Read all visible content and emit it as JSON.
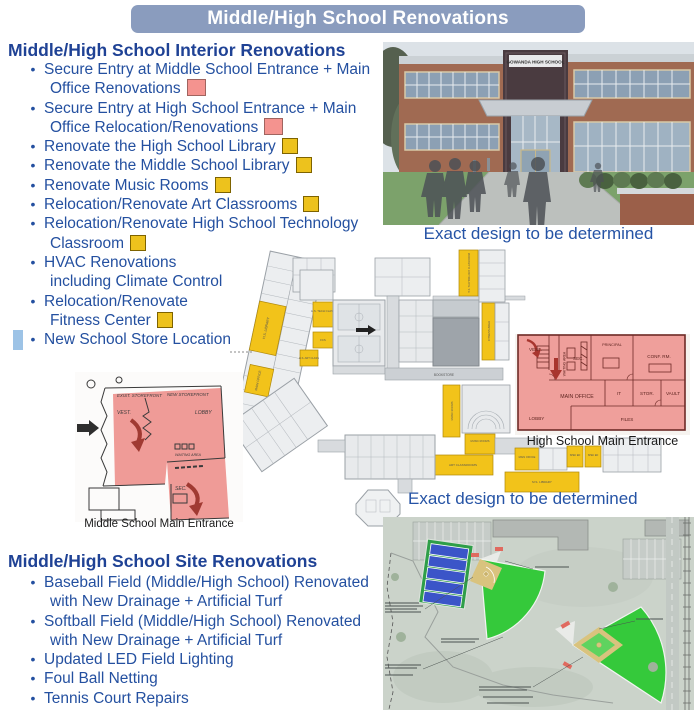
{
  "title": "Middle/High School Renovations",
  "interior": {
    "heading": "Middle/High School Interior Renovations",
    "items": [
      {
        "lines": [
          "Secure Entry at Middle School Entrance + Main",
          "Office Renovations"
        ],
        "swatch": "pink"
      },
      {
        "lines": [
          "Secure Entry at High School Entrance + Main",
          "Office Relocation/Renovations"
        ],
        "swatch": "pink"
      },
      {
        "lines": [
          "Renovate the High School Library"
        ],
        "swatch": "yellow"
      },
      {
        "lines": [
          "Renovate the Middle School Library"
        ],
        "swatch": "yellow"
      },
      {
        "lines": [
          "Renovate Music Rooms"
        ],
        "swatch": "yellow"
      },
      {
        "lines": [
          "Relocation/Renovate Art Classrooms"
        ],
        "swatch": "yellow"
      },
      {
        "lines": [
          "Relocation/Renovate High School Technology",
          "Classroom"
        ],
        "swatch": "yellow"
      },
      {
        "lines": [
          "HVAC Renovations",
          "including Climate Control"
        ],
        "swatch": "none"
      },
      {
        "lines": [
          "Relocation/Renovate",
          "Fitness Center"
        ],
        "swatch": "yellow"
      },
      {
        "lines": [
          "New School Store Location"
        ],
        "swatch": "none",
        "highlight": true
      }
    ]
  },
  "site": {
    "heading": "Middle/High School Site Renovations",
    "items": [
      {
        "lines": [
          "Baseball Field (Middle/High School) Renovated",
          "with New Drainage + Artificial Turf"
        ],
        "swatch": "none"
      },
      {
        "lines": [
          "Softball Field (Middle/High School) Renovated",
          "with New Drainage + Artificial Turf"
        ],
        "swatch": "none"
      },
      {
        "lines": [
          "Updated LED Field Lighting"
        ],
        "swatch": "none"
      },
      {
        "lines": [
          "Foul Ball Netting"
        ],
        "swatch": "none"
      },
      {
        "lines": [
          "Tennis Court Repairs"
        ],
        "swatch": "none"
      }
    ]
  },
  "rendering": {
    "sign": "GOWANDA HIGH SCHOOL",
    "caption": "Exact design to be determined"
  },
  "floorplan": {
    "caption": "Exact design to be determined",
    "labels": {
      "hs_library": "H.S. LIBRARY",
      "main_office_wing": "MAIN OFFICE",
      "hs_tech_class": "H.S. TECH CLASS",
      "fcs": "FCS",
      "hs_art_class": "H.S. ART CLASS",
      "hs_technology_classroom": "H.S. TECHNOLOGY CLASSROOM",
      "fitness_area": "FITNESS AREA",
      "bookstore": "BOOKSTORE",
      "music_rooms_1": "MUSIC ROOMS",
      "music_rooms_2": "MUSIC ROOMS",
      "art_classrooms": "ART CLASSROOMS",
      "main_office_hs": "MAIN OFFICE",
      "spec_ed_1": "SPEC ED",
      "spec_ed_2": "SPEC ED",
      "ms_library": "M.S. LIBRARY"
    }
  },
  "hs_plan": {
    "caption": "High School Main Entrance",
    "labels": {
      "vest": "VEST.",
      "waiting": "WAITING AREA",
      "sec": "SEC.",
      "principal": "PRINCIPAL",
      "conf": "CONF. RM.",
      "main_office": "MAIN OFFICE",
      "it": "IT",
      "stor": "STOR.",
      "vault": "VAULT",
      "lobby": "LOBBY",
      "files": "FILES"
    }
  },
  "ms_plan": {
    "caption": "Middle School Main Entrance",
    "labels": {
      "exist_storefront": "EXIST. STOREFRONT",
      "new_storefront": "NEW STOREFRONT",
      "vest": "VEST.",
      "lobby": "LOBBY",
      "waiting": "WAITING AREA",
      "sec": "SEC."
    }
  },
  "colors": {
    "banner_bg": "#8A9CBE",
    "heading_text": "#1F4295",
    "bullet_text": "#2450A0",
    "pink_swatch": "#F4938F",
    "yellow_swatch": "#EDC21D",
    "highlight_blue": "#9DC3E6",
    "plan_yellow": "#F2C31A",
    "plan_red": "#EF9F9B"
  }
}
